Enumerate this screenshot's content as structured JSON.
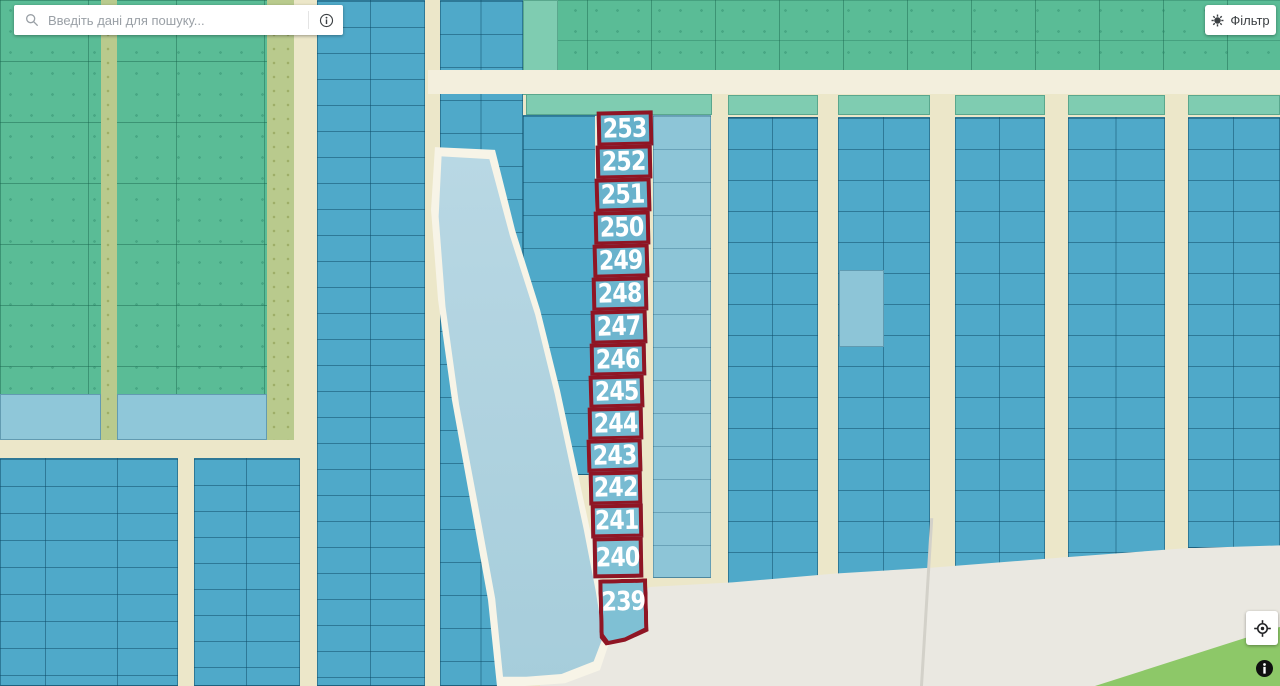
{
  "search": {
    "placeholder": "Введіть дані для пошуку...",
    "icon": "magnifier-icon",
    "info_icon": "info-circle-icon"
  },
  "filter": {
    "label": "Фільтр",
    "icon": "filter-gear-icon"
  },
  "map_controls": {
    "geolocate_icon": "crosshair-target-icon",
    "info_icon": "info-filled-icon"
  },
  "map": {
    "selected_parcels": [
      {
        "label": "253"
      },
      {
        "label": "252"
      },
      {
        "label": "251"
      },
      {
        "label": "250"
      },
      {
        "label": "249"
      },
      {
        "label": "248"
      },
      {
        "label": "247"
      },
      {
        "label": "246"
      },
      {
        "label": "245"
      },
      {
        "label": "244"
      },
      {
        "label": "243"
      },
      {
        "label": "242"
      },
      {
        "label": "241"
      },
      {
        "label": "240"
      },
      {
        "label": "239"
      }
    ],
    "colors": {
      "selection_outline": "#8f1524",
      "parcel_blue": "#4fa9c9",
      "parcel_blue_light": "#8dc5d7",
      "field_green": "#5abc96",
      "strip_olive": "#b9ca8d",
      "water_light_blue": "#abd0de",
      "road_cream": "#efeacf",
      "open_gray": "#eae8e1",
      "corner_green": "#8dc868"
    }
  }
}
